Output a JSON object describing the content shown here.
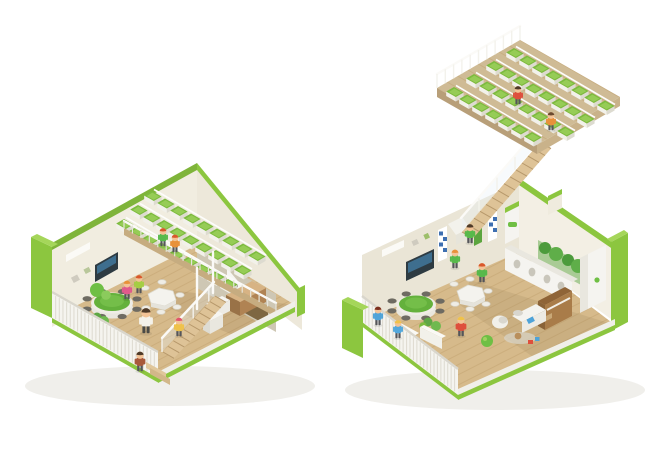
{
  "background": "#FFFFFF",
  "palette": {
    "lime": "#8CC63F",
    "limeSoft": "#7FB43A",
    "limeLight": "#A5D65A",
    "limeDark": "#6FA32F",
    "cream": "#F1EDE0",
    "creamLit": "#F3EFE4",
    "creamShade": "#EDE8DA",
    "creamDark": "#CEC7B4",
    "white": "#F5F4F0",
    "whiteShade": "#E9E7DF",
    "wood": "#D6BA8B",
    "woodShade": "#C6AC80",
    "woodDark": "#7E6742",
    "stairWood": "#DEC397",
    "deck": "#CFBB95",
    "planterGreen": "#7CBB3E",
    "planterLight": "#9FD25F",
    "tableGreen": "#64B13C",
    "tvScreen": "#2E3B42",
    "stool": "#6E6B62",
    "glass": "#E8F1F5",
    "shadow": "#F0EFEB"
  },
  "scene": {
    "units": [
      {
        "id": "left-classroom",
        "features": [
          "green-shell",
          "mezzanine-planter-tiers",
          "interior-staircase",
          "green-round-table",
          "hex-table",
          "tv-screen",
          "slat-fence",
          "wood-floor"
        ]
      },
      {
        "id": "right-classroom",
        "features": [
          "green-shell",
          "roof-garden",
          "roof-staircase",
          "green-round-table",
          "hex-table",
          "piano",
          "sofa",
          "cubby-shelf",
          "slat-fence",
          "wood-floor"
        ]
      }
    ],
    "left_mezzanine": {
      "rows": 3,
      "boxes_per_row": 9
    },
    "roof_garden": {
      "rows": 4,
      "boxes_per_row": 8
    },
    "people": [
      {
        "unit": "left",
        "x": 163,
        "y": 246,
        "s": 0.72,
        "shirt": "#58B94B",
        "hair": "#D9572B"
      },
      {
        "unit": "left",
        "x": 175,
        "y": 252,
        "s": 0.7,
        "shirt": "#E8913A",
        "hair": "#D9572B"
      },
      {
        "unit": "left",
        "x": 127,
        "y": 299,
        "s": 0.74,
        "shirt": "#E05A8C",
        "hair": "#E8913A"
      },
      {
        "unit": "left",
        "x": 139,
        "y": 293,
        "s": 0.72,
        "shirt": "#A4CE44",
        "hair": "#D9572B"
      },
      {
        "unit": "left",
        "x": 146,
        "y": 333,
        "s": 1.0,
        "shirt": "#F4F2EA",
        "hair": "#4E3A28",
        "pants": "#4A4A46"
      },
      {
        "unit": "left",
        "x": 179,
        "y": 336,
        "s": 0.74,
        "shirt": "#EFC24A",
        "hair": "#E0566B"
      },
      {
        "unit": "left",
        "x": 140,
        "y": 371,
        "s": 0.78,
        "shirt": "#A8593B",
        "hair": "#4E3A28"
      },
      {
        "unit": "roof",
        "x": 518,
        "y": 104,
        "s": 0.72,
        "shirt": "#DE4F3C",
        "hair": "#4E3A28"
      },
      {
        "unit": "roof",
        "x": 551,
        "y": 130,
        "s": 0.72,
        "shirt": "#E8913A",
        "hair": "#6B4A2F"
      },
      {
        "unit": "right",
        "x": 378,
        "y": 325,
        "s": 0.74,
        "shirt": "#4FA3D8",
        "hair": "#7A2F1F"
      },
      {
        "unit": "right",
        "x": 398,
        "y": 338,
        "s": 0.72,
        "shirt": "#53A8DC",
        "hair": "#EFC24A"
      },
      {
        "unit": "right",
        "x": 461,
        "y": 336,
        "s": 0.78,
        "shirt": "#DE4F3C",
        "hair": "#EFC24A"
      },
      {
        "unit": "right",
        "x": 470,
        "y": 243,
        "s": 0.76,
        "shirt": "#58B94B",
        "hair": "#4E3A28"
      },
      {
        "unit": "right",
        "x": 455,
        "y": 268,
        "s": 0.74,
        "shirt": "#58B94B",
        "hair": "#E8913A"
      },
      {
        "unit": "right",
        "x": 482,
        "y": 282,
        "s": 0.76,
        "shirt": "#58B94B",
        "hair": "#D9572B"
      }
    ]
  }
}
